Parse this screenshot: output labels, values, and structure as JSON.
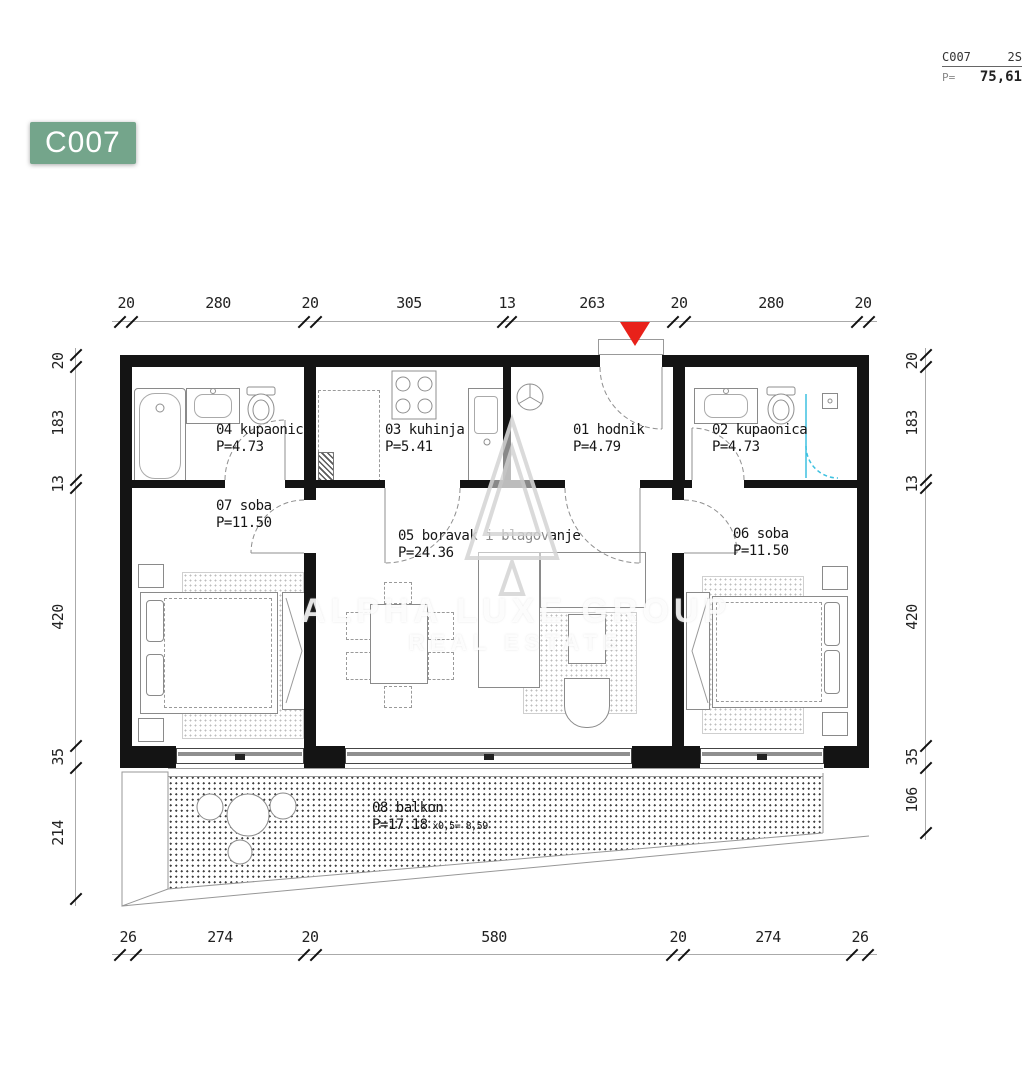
{
  "header": {
    "unit": "C007",
    "type": "2S",
    "area_label": "P=",
    "area_value": "75,61"
  },
  "badge": {
    "label": "C007"
  },
  "watermark": {
    "line1": "ALPHA LUXE GROUP",
    "line2": "REAL ESTATE"
  },
  "rooms": {
    "r01": {
      "name": "01 hodnik",
      "area": "P=4.79"
    },
    "r02": {
      "name": "02 kupaonica",
      "area": "P=4.73"
    },
    "r03": {
      "name": "03 kuhinja",
      "area": "P=5.41"
    },
    "r04": {
      "name": "04 kupaonica",
      "area": "P=4.73"
    },
    "r05": {
      "name": "05 boravak i blagovanje",
      "area": "P=24.36"
    },
    "r06": {
      "name": "06 soba",
      "area": "P=11.50"
    },
    "r07": {
      "name": "07 soba",
      "area": "P=11.50"
    },
    "r08": {
      "name": "08 balkon",
      "area": "P=17.18",
      "factor": "x0,5= 8,59"
    }
  },
  "dimensions": {
    "top": [
      "20",
      "280",
      "20",
      "305",
      "13",
      "263",
      "20",
      "280",
      "20"
    ],
    "bottom": [
      "26",
      "274",
      "20",
      "580",
      "20",
      "274",
      "26"
    ],
    "left": [
      "20",
      "183",
      "13",
      "420",
      "35",
      "214"
    ],
    "right": [
      "20",
      "183",
      "13",
      "420",
      "35",
      "106"
    ]
  },
  "colors": {
    "wall": "#141414",
    "badge": "#74A58B",
    "marker": "#E8211A",
    "glass": "#3EC1E0"
  }
}
